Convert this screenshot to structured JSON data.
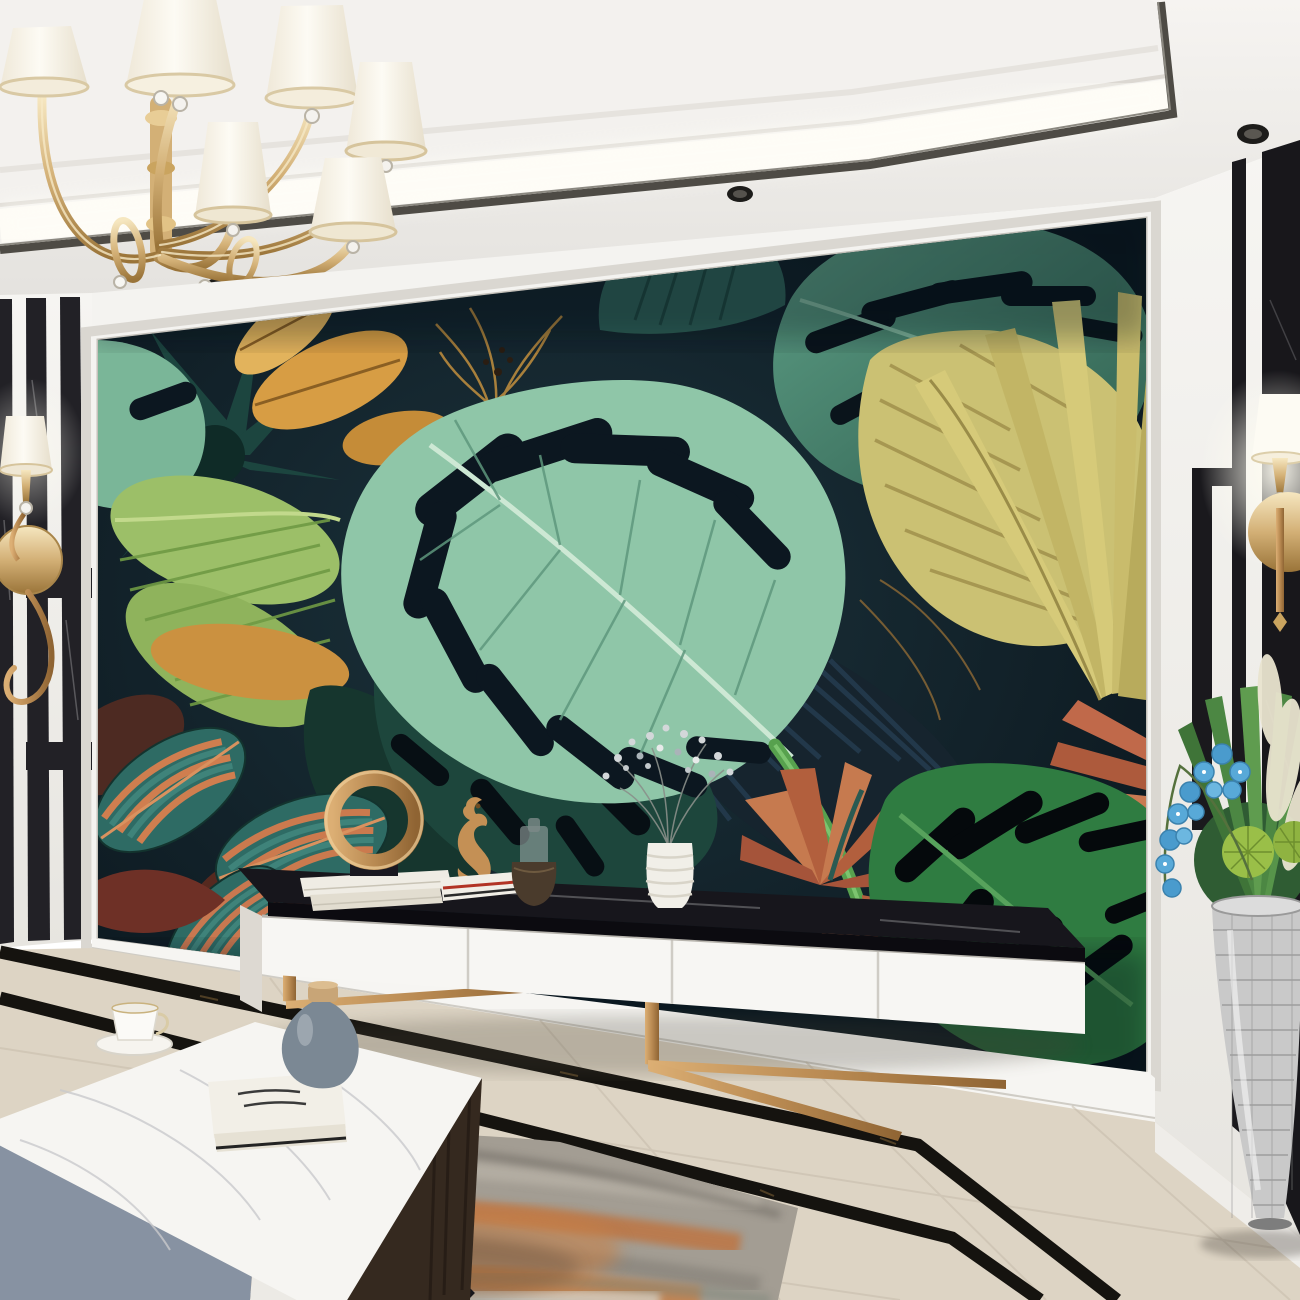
{
  "scene": {
    "title": "Modern luxury living room with 3D tropical leaf mural feature wall",
    "setting": "interior rendering, recessed cove lighting, polished marble floor",
    "mural_description": "oversized mint and dark green monstera leaves, golden palm and banana leaves, striped calathea leaves and terracotta tropical blooms on a dark navy background",
    "furniture": [
      "white floating TV sideboard with black marble top and brass sled legs",
      "white marble coffee table with slate-grey and white drawers, dark wood side and black angular legs",
      "mirror-mosaic floor vase planter"
    ],
    "lighting": [
      "gold crystal chandelier with pleated ivory shades",
      "recessed ceiling spotlights",
      "ceiling cove strip light",
      "gold wall sconce on striped left wall",
      "gold wall sconce on black marble right panel"
    ],
    "decor": [
      "brass ring sculpture on stacked books",
      "brass seahorse figurine on books",
      "smoked glass candle jar in bronze pot",
      "white ribbed vase with gypsophila",
      "porcelain teacup with saucer",
      "grey teardrop vase with cork lid",
      "stacked art books",
      "blue orchid stems, green fan palms, cactus balls and cream pampas plumes"
    ],
    "floor": "cream marble with double black marble inlay border and grey-rust abstract rug"
  },
  "palette": {
    "ceiling_white": "#efedea",
    "cove_glow": "#fcf9f1",
    "trim_dark": "#4e4b45",
    "wall_white": "#f4f3f0",
    "black_marble": "#1a191d",
    "mural_background": "#0d1b23",
    "mint_leaf": "#8fc6a8",
    "sea_green_leaf": "#4e8f77",
    "deep_green_leaf": "#2f7c41",
    "navy_leaf": "#16242e",
    "yellow_leaf": "#cbc173",
    "gold_leaf": "#d79d44",
    "fern_green": "#9cbf68",
    "calathea_teal": "#2e6b64",
    "rust_bloom": "#b25f3d",
    "gold_metal": "#d3b076",
    "copper_leg": "#c08a52",
    "console_white": "#f7f6f3",
    "slab_black": "#17161c",
    "floor_marble": "#ddd4c4",
    "floor_inlay": "#15130f",
    "rug_grey": "#a39d93",
    "rug_rust": "#c17039",
    "drawer_grey": "#8792a2",
    "vase_grey": "#7b8894",
    "orchid_blue": "#58a9d8",
    "plume_cream": "#e9e4cf",
    "mosaic_silver": "#c9c9c9"
  }
}
